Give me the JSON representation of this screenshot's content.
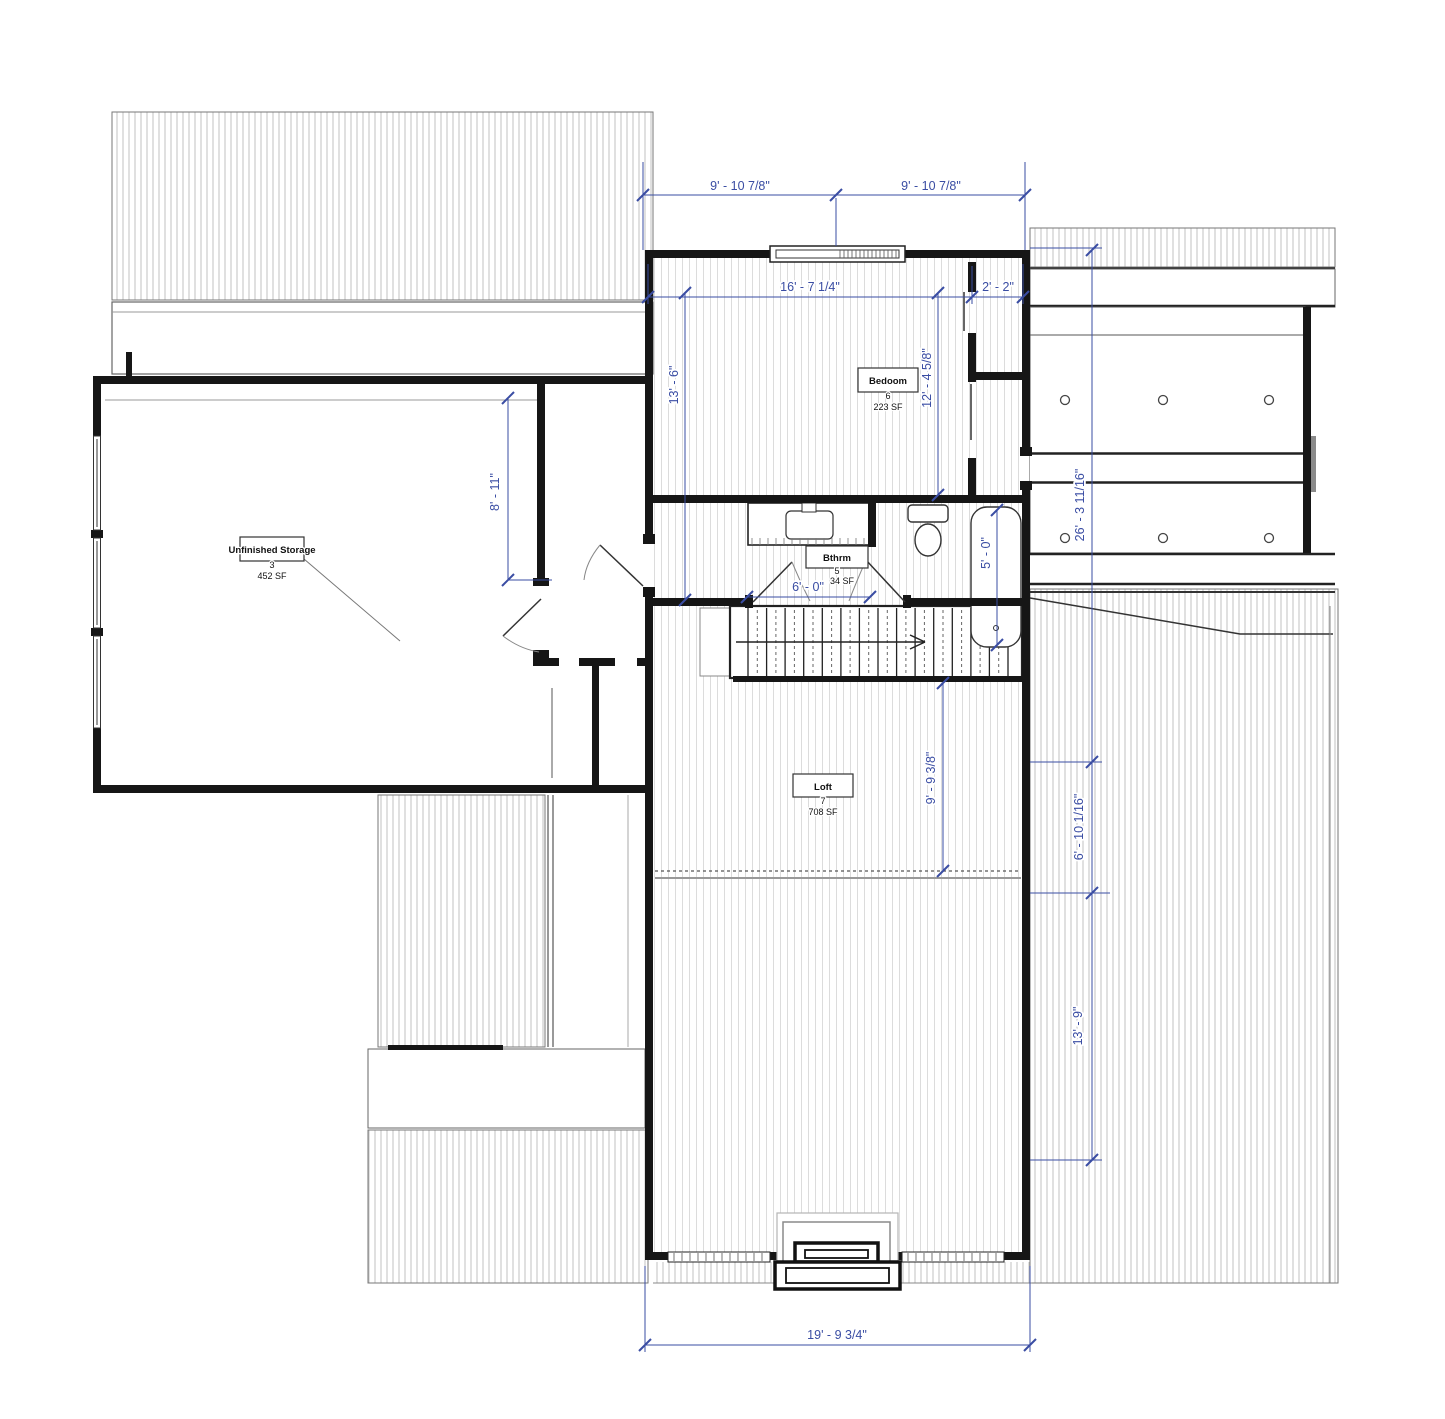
{
  "meta": {
    "drawing_type": "floor-plan",
    "colors": {
      "dimension": "#3a4da3",
      "wall": "#161616",
      "hatch": "#c2c2c2"
    }
  },
  "rooms": {
    "storage": {
      "name": "Unfinished Storage",
      "number": "3",
      "area": "452 SF"
    },
    "bedroom": {
      "name": "Bedoom",
      "number": "6",
      "area": "223 SF"
    },
    "bath": {
      "name": "Bthrm",
      "number": "5",
      "area": "34 SF"
    },
    "loft": {
      "name": "Loft",
      "number": "7",
      "area": "708 SF"
    }
  },
  "dims": {
    "top_left": "9' - 10 7/8\"",
    "top_right": "9' - 10 7/8\"",
    "room_width": "16' - 7 1/4\"",
    "closet_width": "2' - 2\"",
    "left_height": "13' - 6\"",
    "right_height": "12' - 4 5/8\"",
    "storage_side": "8' - 11\"",
    "bath_width": "6' - 0\"",
    "tub_length": "5' - 0\"",
    "right_total": "26' - 3 11/16\"",
    "loft_depth": "9' - 9 3/8\"",
    "roof_mid": "6' - 10 1/16\"",
    "roof_lower": "13' - 9\"",
    "bottom_width": "19' - 9 3/4\""
  }
}
